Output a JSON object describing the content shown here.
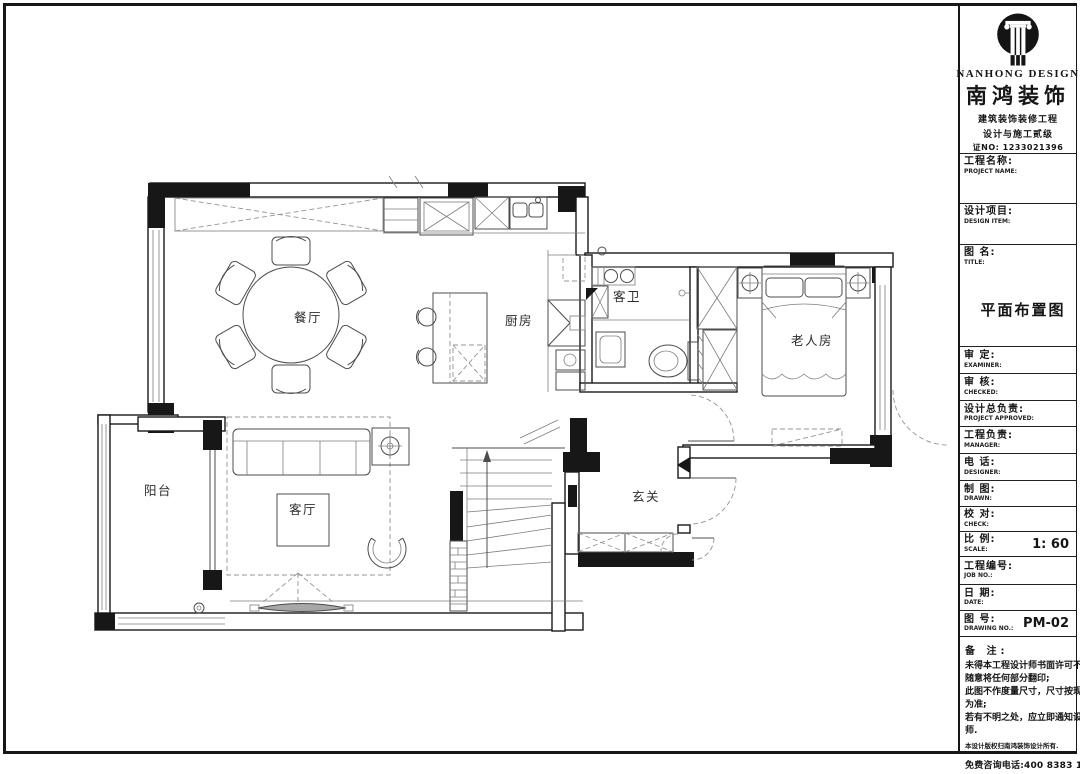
{
  "title_block": {
    "company_en": "NANHONG DESIGN",
    "company_cn": "南鸿装饰",
    "cert_line1": "建筑装饰装修工程",
    "cert_line2": "设计与施工贰级",
    "cert_no": "证NO: 1233021396",
    "fields": [
      {
        "cn": "工程名称:",
        "en": "PROJECT NAME:",
        "value": ""
      },
      {
        "cn": "设计项目:",
        "en": "DESIGN ITEM:",
        "value": ""
      },
      {
        "cn": "图  名:",
        "en": "TITLE:",
        "value": "平面布置图"
      },
      {
        "cn": "审  定:",
        "en": "EXAMINER:",
        "value": ""
      },
      {
        "cn": "审  核:",
        "en": "CHECKED:",
        "value": ""
      },
      {
        "cn": "设计总负责:",
        "en": "PROJECT APPROVED:",
        "value": ""
      },
      {
        "cn": "工程负责:",
        "en": "MANAGER:",
        "value": ""
      },
      {
        "cn": "电  话:",
        "en": "DESIGNER:",
        "value": ""
      },
      {
        "cn": "制  图:",
        "en": "DRAWN:",
        "value": ""
      },
      {
        "cn": "校  对:",
        "en": "CHECK:",
        "value": ""
      },
      {
        "cn": "比  例:",
        "en": "SCALE:",
        "value": "1: 60"
      },
      {
        "cn": "工程编号:",
        "en": "JOB NO.:",
        "value": ""
      },
      {
        "cn": "日  期:",
        "en": "DATE:",
        "value": ""
      },
      {
        "cn": "图  号:",
        "en": "DRAWING NO.:",
        "value": "PM-02"
      }
    ],
    "notes": {
      "title": "备  注:",
      "lines": [
        "未得本工程设计师书面许可不得",
        "随意将任何部分翻印;",
        "此图不作度量尺寸，尺寸按现场",
        "为准;",
        "若有不明之处，应立即通知设计",
        "师."
      ],
      "copyright": "本设计版权归南鸿装饰设计所有.",
      "hotline": "免费咨询电话:400 8383 168"
    }
  },
  "floor_plan": {
    "drawing_title": "平面布置图",
    "rooms": {
      "dining": "餐厅",
      "kitchen": "厨房",
      "bath": "客卫",
      "elder": "老人房",
      "balcony": "阳台",
      "living": "客厅",
      "foyer": "玄关"
    }
  }
}
